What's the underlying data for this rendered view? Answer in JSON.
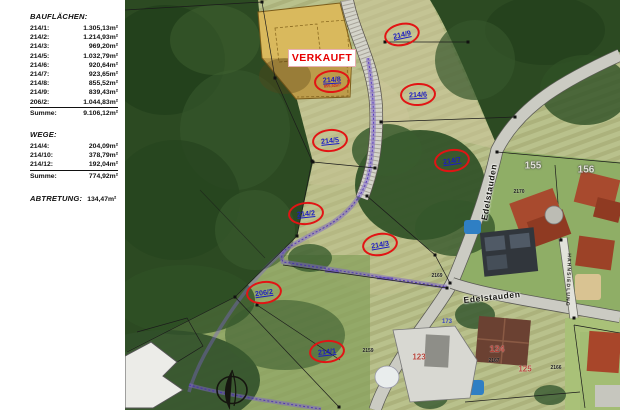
{
  "sidebar": {
    "bauflaechen": {
      "title": "BAUFLÄCHEN:",
      "rows": [
        {
          "label": "214/1:",
          "value": "1.305,13m²"
        },
        {
          "label": "214/2:",
          "value": "1.214,93m²"
        },
        {
          "label": "214/3:",
          "value": "969,20m²"
        },
        {
          "label": "214/5:",
          "value": "1.032,79m²"
        },
        {
          "label": "214/6:",
          "value": "920,64m²"
        },
        {
          "label": "214/7:",
          "value": "923,65m²"
        },
        {
          "label": "214/8:",
          "value": "855,52m²"
        },
        {
          "label": "214/9:",
          "value": "839,43m²"
        },
        {
          "label": "206/2:",
          "value": "1.044,83m²"
        }
      ],
      "summe_label": "Summe:",
      "summe_value": "9.106,12m²"
    },
    "wege": {
      "title": "WEGE:",
      "rows": [
        {
          "label": "214/4:",
          "value": "204,09m²"
        },
        {
          "label": "214/10:",
          "value": "378,79m²"
        },
        {
          "label": "214/12:",
          "value": "192,04m²"
        }
      ],
      "summe_label": "Summe:",
      "summe_value": "774,92m²"
    },
    "abtretung": {
      "label": "ABTRETUNG:",
      "value": "134,47m²"
    }
  },
  "map": {
    "verkauft_sign": "VERKAUFT",
    "parcel_ellipses": [
      {
        "text": "214/9"
      },
      {
        "text": "214/8",
        "subtext": "855,52m²"
      },
      {
        "text": "214/6"
      },
      {
        "text": "214/5"
      },
      {
        "text": "214/7"
      },
      {
        "text": "214/2"
      },
      {
        "text": "214/3"
      },
      {
        "text": "206/2"
      },
      {
        "text": "214/1"
      }
    ],
    "house_numbers": [
      {
        "text": "155"
      },
      {
        "text": "156"
      },
      {
        "text": "124"
      },
      {
        "text": "125"
      },
      {
        "text": "123"
      },
      {
        "text": "173"
      }
    ],
    "parcel_numbers": [
      {
        "text": "2170"
      },
      {
        "text": "2169"
      },
      {
        "text": "2167"
      },
      {
        "text": "2166"
      },
      {
        "text": "2159"
      }
    ],
    "street_names": {
      "main_road": "Edelstauden",
      "lower_road": "Edelstauden",
      "side_lane": "HAHNSIEDLUNG"
    },
    "colors": {
      "ellipse_red": "#e21414",
      "parcel_label_blue": "#1c1cc4",
      "verkauft_red": "#e60000",
      "sold_parcel_tan": "#d9b95d",
      "forest_green": "#2c4a22",
      "field_green": "#b9c18c"
    }
  }
}
